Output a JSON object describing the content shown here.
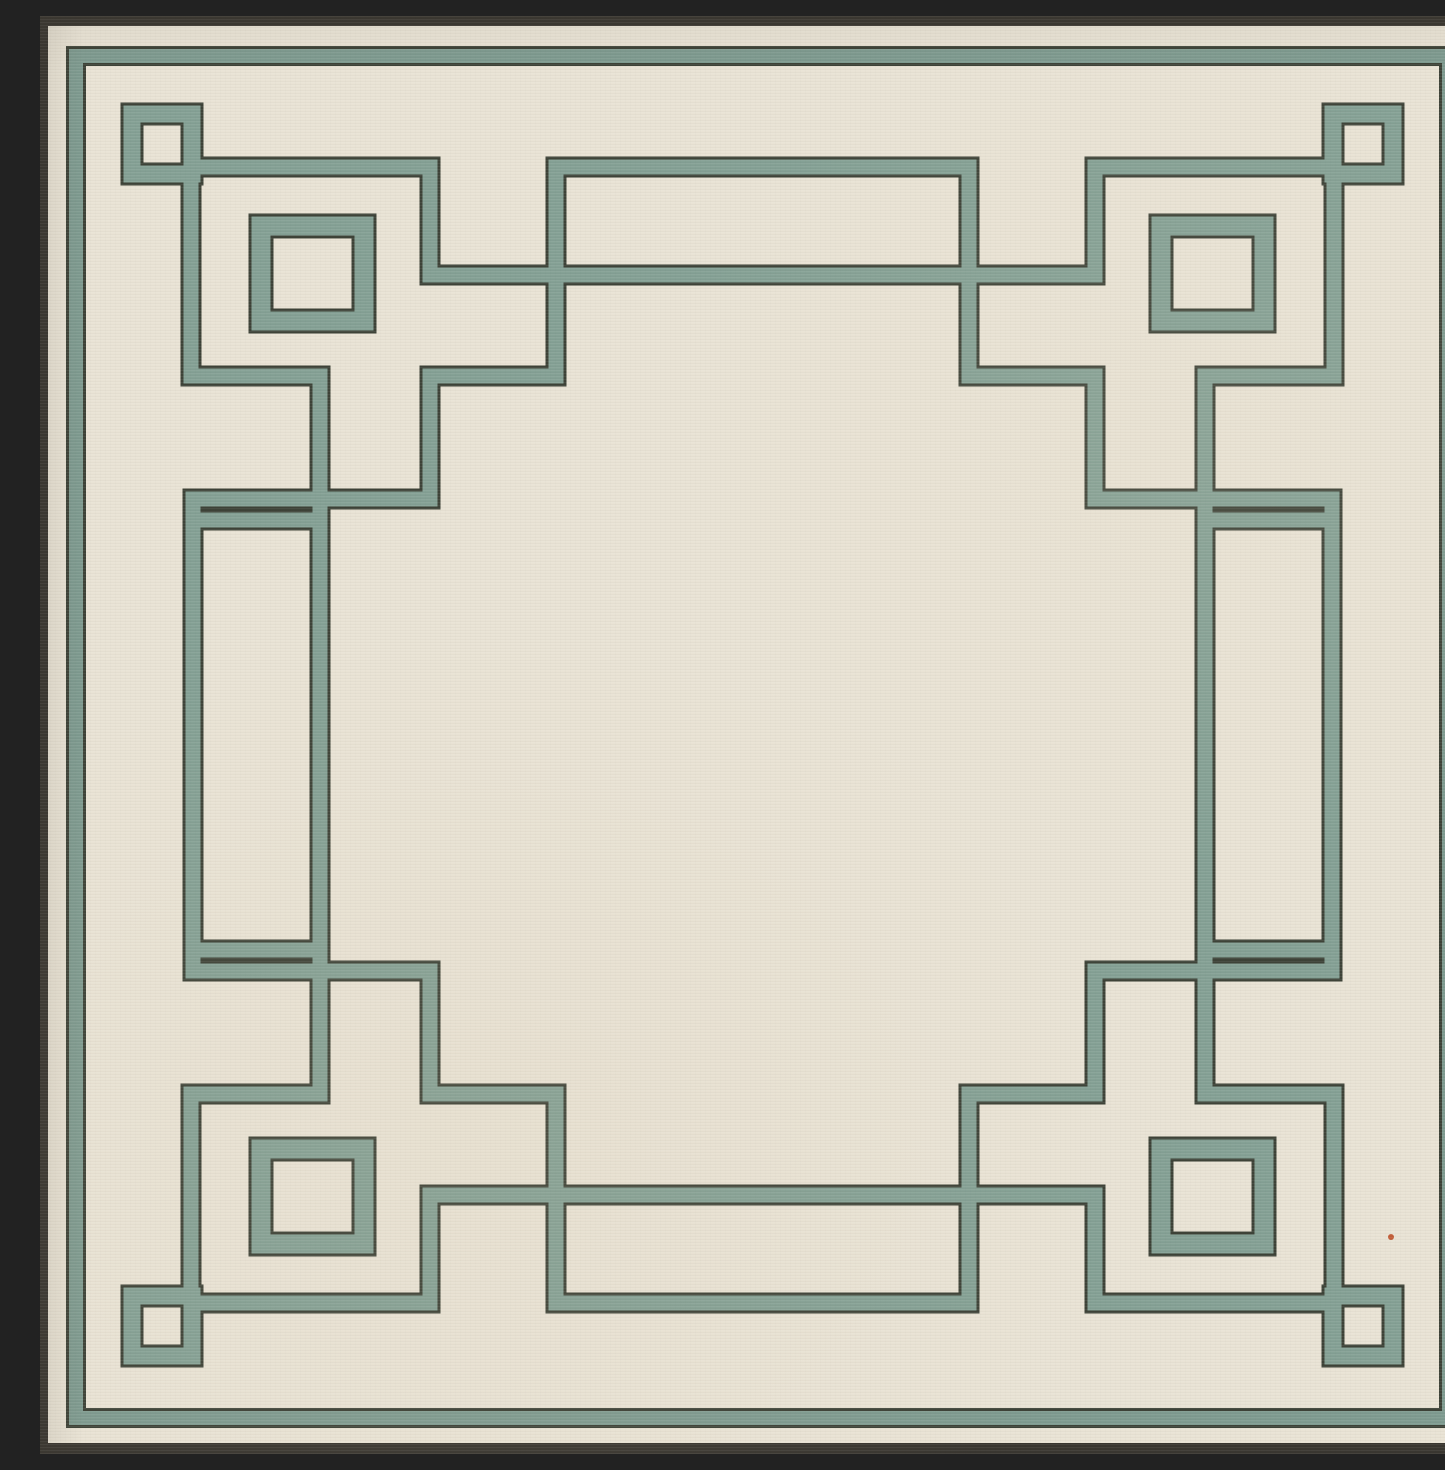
{
  "image": {
    "kind": "product photo",
    "subject": "square flat-weave area rug, edge-to-edge in frame",
    "width_px": 1445,
    "height_px": 1438
  },
  "rug": {
    "shape": "square",
    "field_color_name": "ivory / cream",
    "accent_color_name": "sage green",
    "edge_binding_color_name": "charcoal",
    "pattern": "Art-Deco Greek key fretwork border: thin perimeter band, interlocking meander lines, small open square in each corner and larger open square inset at each corner",
    "center_field": "empty cream field",
    "texture": "fine horizontal weave ribs"
  },
  "colors": {
    "field_cream": "#E9E3D5",
    "band_green": "#85A195",
    "perimeter_green": "#7F9B90",
    "band_edge_dark": "#3E4338",
    "rug_edge_dark": "#3A3731",
    "fleck_orange": "#C25F3A"
  }
}
